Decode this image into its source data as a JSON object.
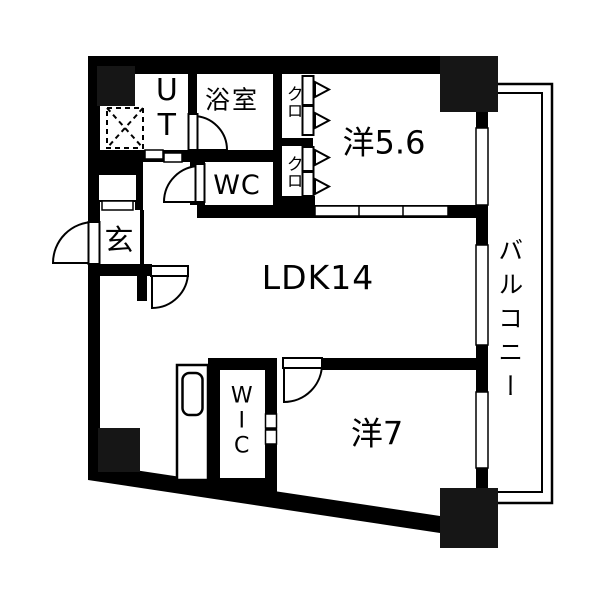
{
  "title": "2LDK マンション間取り図",
  "rooms": {
    "ldk": {
      "label": "LDK14"
    },
    "bedroom1": {
      "label": "洋5.6"
    },
    "bedroom2": {
      "label": "洋7"
    },
    "bathroom": {
      "label": "浴室"
    },
    "toilet": {
      "label": "WC"
    },
    "utility": {
      "label": "UT"
    },
    "wic": {
      "label": "WIC"
    },
    "closet_upper": {
      "label": "クロ"
    },
    "closet_lower": {
      "label": "クロ"
    },
    "entrance": {
      "label": "玄"
    },
    "balcony": {
      "label": "バルコニー"
    }
  },
  "colors": {
    "wall": "#000000",
    "pillar": "#161616",
    "background": "#ffffff"
  }
}
